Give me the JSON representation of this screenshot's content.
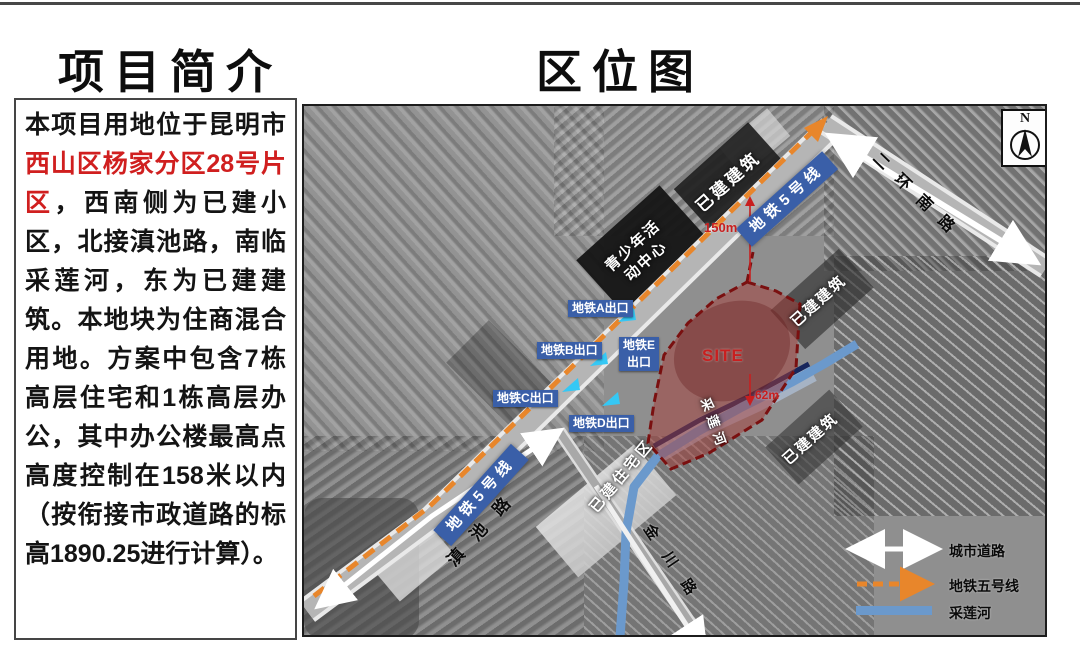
{
  "left_panel": {
    "title": "项目简介",
    "description": {
      "before_red": "本项目用地位于昆明市",
      "red": "西山区杨家分区28号片区",
      "after_red": "，西南侧为已建小区，北接滇池路，南临采莲河，东为已建建筑。本地块为住商混合用地。方案中包含7栋高层住宅和1栋高层办公，其中办公楼最高点高度控制在158米以内（按衔接市政道路的标高1890.25进行计算）。"
    },
    "red_color": "#d01f1f"
  },
  "map": {
    "title": "区位图",
    "north_label": "N",
    "site_label": "SITE",
    "dim_150": "150m",
    "dim_62": "62m",
    "metro_banner": "地铁5号线",
    "roads": {
      "dianchi": "滇池路",
      "erhuan": "二环南路",
      "jinchuan": "金川路"
    },
    "river_label": "采莲河",
    "areas": {
      "built_top": "已建建筑",
      "built_right": "已建建筑",
      "built_bottom": "已建建筑",
      "residential": "已建住宅区",
      "youth_center_line1": "青少年活",
      "youth_center_line2": "动中心"
    },
    "exits": [
      {
        "label": "地铁A出口"
      },
      {
        "label": "地铁B出口"
      },
      {
        "label": "地铁C出口"
      },
      {
        "label": "地铁D出口"
      },
      {
        "label": "地铁E",
        "label2": "出口"
      }
    ],
    "legend": [
      {
        "label": "城市道路",
        "symbol": "white-double-arrow"
      },
      {
        "label": "地铁五号线",
        "symbol": "orange-dashed-arrow"
      },
      {
        "label": "采莲河",
        "symbol": "blue-line"
      }
    ],
    "colors": {
      "metro_line": "#e8862b",
      "metro_banner_bg": "#3a5fa8",
      "exit_label_bg": "#3a5fa8",
      "exit_arrow": "#35c8f5",
      "site_fill": "#a03c38",
      "site_border": "#7a1010",
      "river": "#6b99cc",
      "dimension_red": "#c81f1f"
    }
  }
}
